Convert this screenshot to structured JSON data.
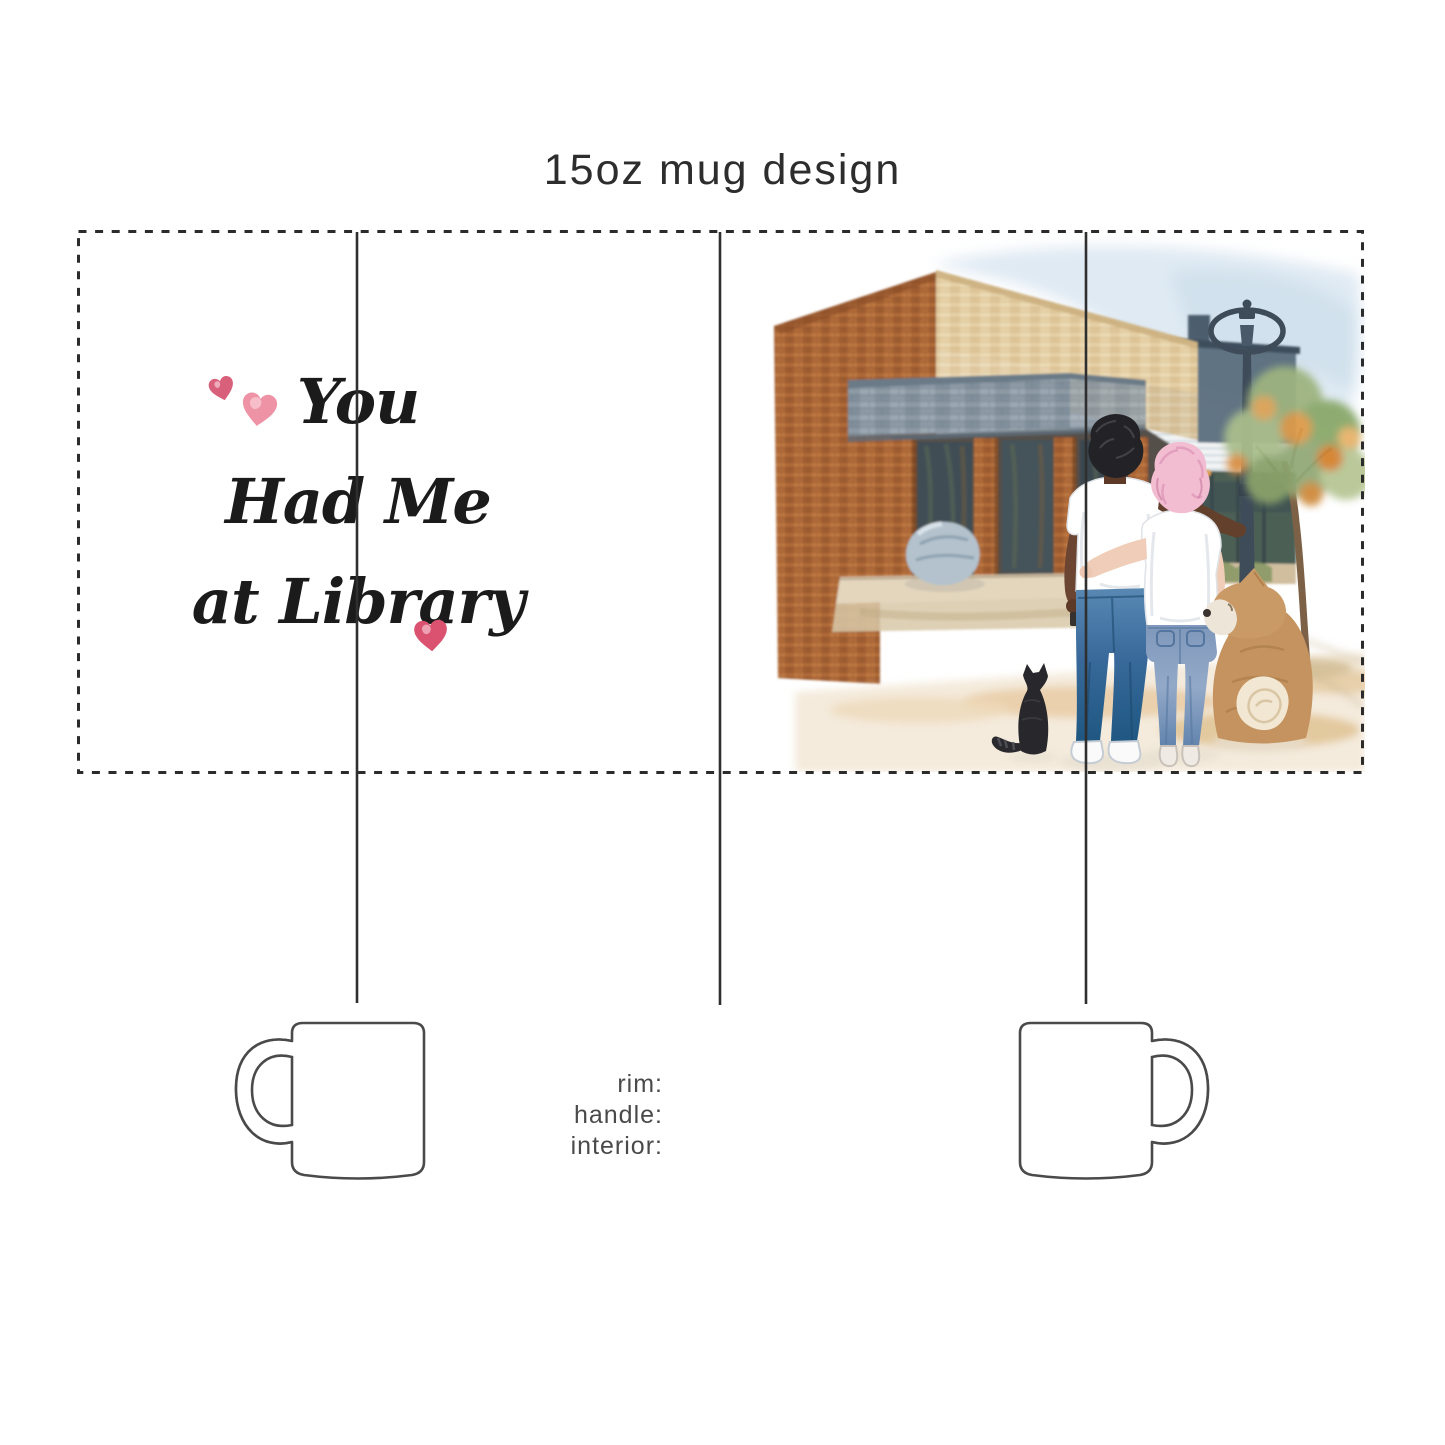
{
  "header": {
    "title": "15oz mug design"
  },
  "wrap_design": {
    "quote": {
      "lines": [
        "You",
        "Had Me",
        "at Library"
      ],
      "color": "#1b1b1b"
    },
    "hearts": {
      "count": 3,
      "colors": {
        "small": "#d9607a",
        "large": "#ee92a5",
        "bottom": "#da5270",
        "highlight": "#f9ccd6"
      }
    },
    "illustration": {
      "elements": [
        "library-building",
        "brick-wall",
        "stone-canopy",
        "storefront-windows",
        "boulder",
        "street-lamp",
        "autumn-tree",
        "background-building",
        "sidewalk",
        "man",
        "woman",
        "black-cat",
        "dog"
      ]
    }
  },
  "spec_labels": {
    "rim": "rim:",
    "handle": "handle:",
    "interior": "interior:"
  },
  "guides": {
    "cut_border_color": "#2b2b2b",
    "fold_line_color": "#2f2f2f",
    "mug_outline_color": "#4a4a4a"
  }
}
